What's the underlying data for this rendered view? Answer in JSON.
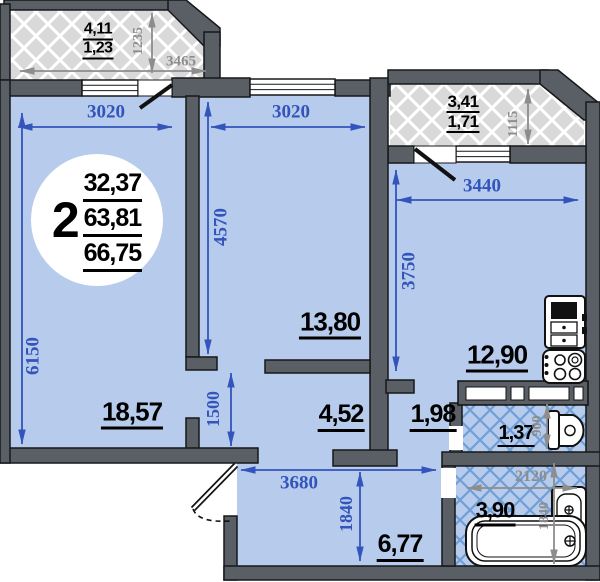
{
  "badge": {
    "rooms": "2",
    "living_area": "32,37",
    "usable_area": "63,81",
    "total_area": "66,75"
  },
  "rooms": {
    "living_room": {
      "area": "18,57",
      "width": "3020",
      "depth": "6150"
    },
    "bedroom": {
      "area": "13,80",
      "width": "3020",
      "depth": "4570"
    },
    "kitchen": {
      "area": "12,90",
      "width": "3440",
      "depth": "3750"
    },
    "corridor": {
      "area": "4,52",
      "width": "1500"
    },
    "passage": {
      "area": "1,98"
    },
    "hallway": {
      "area": "6,77",
      "width": "3680",
      "depth": "1840"
    },
    "wc": {
      "area": "1,37",
      "width": "900"
    },
    "bathroom": {
      "area": "3,90",
      "width": "2120",
      "depth": "1840"
    },
    "loggia_left": {
      "area_full": "4,11",
      "area_counted": "1,23",
      "depth": "1235",
      "width": "3465"
    },
    "loggia_right": {
      "area_full": "3,41",
      "area_counted": "1,71",
      "depth": "1115"
    }
  },
  "colors": {
    "floor": "#b7cbec",
    "wall": "#5a5f65",
    "dim_primary": "#3354bb",
    "dim_secondary": "#8d8d8d",
    "loggia_floor": "#d9d9d9",
    "tile_line": "#6f9fd6"
  }
}
